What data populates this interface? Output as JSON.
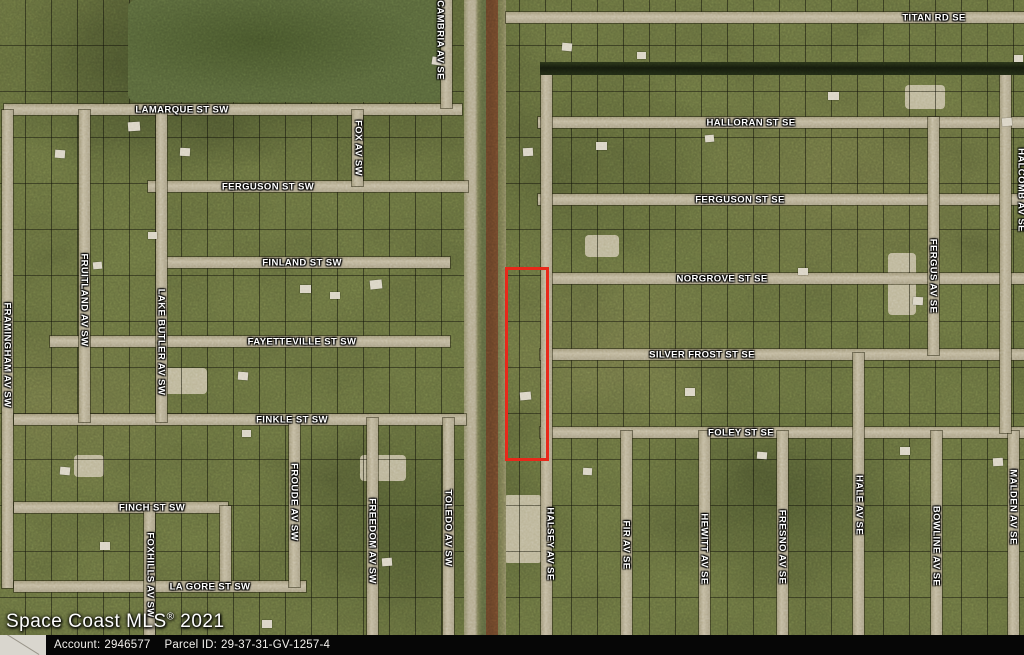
{
  "watermark": {
    "main": "Space Coast MLS",
    "reg": "®",
    "year": "2021"
  },
  "footer": {
    "account_label": "Account:",
    "account_value": "2946577",
    "parcel_label": "Parcel ID:",
    "parcel_value": "29-37-31-GV-1257-4"
  },
  "map": {
    "colors": {
      "highlight_parcel": "#e8281a",
      "road": "#b6ad93",
      "canal": "#1a210f",
      "boundary_line": "#6f2513",
      "footer_bar": "#060606"
    },
    "highlight_parcel": {
      "x": 505,
      "y": 267,
      "w": 38,
      "h": 188,
      "stroke": 3
    },
    "streets": [
      {
        "id": "lamarque-st-sw",
        "o": "h",
        "x": 4,
        "y": 104,
        "len": 458
      },
      {
        "id": "ferguson-st-sw",
        "o": "h",
        "x": 148,
        "y": 181,
        "len": 320
      },
      {
        "id": "finland-st-sw",
        "o": "h",
        "x": 160,
        "y": 257,
        "len": 290
      },
      {
        "id": "fayetteville-st-sw",
        "o": "h",
        "x": 50,
        "y": 336,
        "len": 400
      },
      {
        "id": "finkle-st-sw",
        "o": "h",
        "x": 14,
        "y": 414,
        "len": 452
      },
      {
        "id": "finch-st-sw",
        "o": "h",
        "x": 14,
        "y": 502,
        "len": 214
      },
      {
        "id": "la-gore-st-sw",
        "o": "h",
        "x": 14,
        "y": 581,
        "len": 292
      },
      {
        "id": "titan-rd-se",
        "o": "h",
        "x": 506,
        "y": 12,
        "len": 518
      },
      {
        "id": "halloran-st-se",
        "o": "h",
        "x": 538,
        "y": 117,
        "len": 486
      },
      {
        "id": "ferguson-st-se",
        "o": "h",
        "x": 538,
        "y": 194,
        "len": 486
      },
      {
        "id": "norgrove-st-se",
        "o": "h",
        "x": 548,
        "y": 273,
        "len": 476
      },
      {
        "id": "silver-frost-st-se",
        "o": "h",
        "x": 540,
        "y": 349,
        "len": 484
      },
      {
        "id": "foley-st-se",
        "o": "h",
        "x": 540,
        "y": 427,
        "len": 484
      },
      {
        "id": "cambria-av-se",
        "o": "v",
        "x": 441,
        "y": 0,
        "len": 108
      },
      {
        "id": "fox-av-sw",
        "o": "v",
        "x": 352,
        "y": 110,
        "len": 76
      },
      {
        "id": "framingham-av-sw",
        "o": "v",
        "x": 2,
        "y": 110,
        "len": 478
      },
      {
        "id": "fruitland-av-sw",
        "o": "v",
        "x": 79,
        "y": 110,
        "len": 312
      },
      {
        "id": "lake-butler-av-sw",
        "o": "v",
        "x": 156,
        "y": 110,
        "len": 312
      },
      {
        "id": "foxhills-av-sw",
        "o": "v",
        "x": 144,
        "y": 506,
        "len": 149
      },
      {
        "id": "finch-loop-connector",
        "o": "v",
        "x": 220,
        "y": 506,
        "len": 79
      },
      {
        "id": "froude-av-sw",
        "o": "v",
        "x": 289,
        "y": 418,
        "len": 169
      },
      {
        "id": "freedom-av-sw",
        "o": "v",
        "x": 367,
        "y": 418,
        "len": 237
      },
      {
        "id": "toledo-av-sw",
        "o": "v",
        "x": 443,
        "y": 418,
        "len": 237
      },
      {
        "id": "halsey-av-se",
        "o": "v",
        "x": 541,
        "y": 70,
        "len": 585
      },
      {
        "id": "fir-av-se",
        "o": "v",
        "x": 621,
        "y": 431,
        "len": 224
      },
      {
        "id": "hewitt-av-se",
        "o": "v",
        "x": 699,
        "y": 431,
        "len": 224
      },
      {
        "id": "fresno-av-se",
        "o": "v",
        "x": 777,
        "y": 431,
        "len": 224
      },
      {
        "id": "hale-av-se",
        "o": "v",
        "x": 853,
        "y": 353,
        "len": 302
      },
      {
        "id": "bowline-av-se",
        "o": "v",
        "x": 931,
        "y": 431,
        "len": 224
      },
      {
        "id": "malden-av-se",
        "o": "v",
        "x": 1008,
        "y": 431,
        "len": 224
      },
      {
        "id": "fergus-av-se",
        "o": "v",
        "x": 928,
        "y": 117,
        "len": 238
      },
      {
        "id": "halcomb-av-se",
        "o": "v",
        "x": 1000,
        "y": 70,
        "len": 363
      }
    ],
    "street_labels": [
      {
        "t": "LAMARQUE ST SW",
        "x": 182,
        "y": 110
      },
      {
        "t": "FERGUSON ST SW",
        "x": 268,
        "y": 187
      },
      {
        "t": "FINLAND ST SW",
        "x": 302,
        "y": 263
      },
      {
        "t": "FAYETTEVILLE ST SW",
        "x": 302,
        "y": 342
      },
      {
        "t": "FINKLE ST SW",
        "x": 292,
        "y": 420
      },
      {
        "t": "FINCH ST SW",
        "x": 152,
        "y": 508
      },
      {
        "t": "LA GORE ST SW",
        "x": 210,
        "y": 587
      },
      {
        "t": "TITAN RD SE",
        "x": 934,
        "y": 18
      },
      {
        "t": "HALLORAN ST SE",
        "x": 751,
        "y": 123
      },
      {
        "t": "FERGUSON ST SE",
        "x": 740,
        "y": 200
      },
      {
        "t": "NORGROVE ST SE",
        "x": 722,
        "y": 279
      },
      {
        "t": "SILVER FROST ST SE",
        "x": 702,
        "y": 355
      },
      {
        "t": "FOLEY ST SE",
        "x": 741,
        "y": 433
      },
      {
        "t": "CAMBRIA AV SE",
        "x": 440,
        "y": 40,
        "v": 1
      },
      {
        "t": "FOX AV SW",
        "x": 358,
        "y": 148,
        "v": 1
      },
      {
        "t": "FRAMINGHAM AV SW",
        "x": 7,
        "y": 355,
        "v": 1
      },
      {
        "t": "FRUITLAND AV SW",
        "x": 84,
        "y": 300,
        "v": 1
      },
      {
        "t": "LAKE BUTLER AV SW",
        "x": 161,
        "y": 342,
        "v": 1
      },
      {
        "t": "FOXHILLS AV SW",
        "x": 150,
        "y": 575,
        "v": 1
      },
      {
        "t": "FROUDE AV SW",
        "x": 294,
        "y": 502,
        "v": 1
      },
      {
        "t": "FREEDOM AV SW",
        "x": 372,
        "y": 541,
        "v": 1
      },
      {
        "t": "TOLEDO AV SW",
        "x": 448,
        "y": 528,
        "v": 1
      },
      {
        "t": "HALSEY AV SE",
        "x": 550,
        "y": 544,
        "v": 1
      },
      {
        "t": "FIR AV SE",
        "x": 626,
        "y": 545,
        "v": 1
      },
      {
        "t": "HEWITT AV SE",
        "x": 704,
        "y": 549,
        "v": 1
      },
      {
        "t": "FRESNO AV SE",
        "x": 782,
        "y": 547,
        "v": 1
      },
      {
        "t": "HALE AV SE",
        "x": 859,
        "y": 505,
        "v": 1
      },
      {
        "t": "BOWLINE AV SE",
        "x": 936,
        "y": 546,
        "v": 1
      },
      {
        "t": "MALDEN AV SE",
        "x": 1013,
        "y": 507,
        "v": 1
      },
      {
        "t": "FERGUS AV SE",
        "x": 933,
        "y": 276,
        "v": 1
      },
      {
        "t": "HALCOMB AV SE",
        "x": 1021,
        "y": 190,
        "v": 1
      }
    ],
    "forests": [
      {
        "x": 128,
        "y": 0,
        "w": 314,
        "h": 102
      }
    ],
    "clearings": [
      {
        "x": 163,
        "y": 368,
        "w": 44,
        "h": 26
      },
      {
        "x": 504,
        "y": 495,
        "w": 38,
        "h": 68
      },
      {
        "x": 888,
        "y": 253,
        "w": 28,
        "h": 62
      },
      {
        "x": 74,
        "y": 455,
        "w": 30,
        "h": 22
      },
      {
        "x": 360,
        "y": 455,
        "w": 46,
        "h": 26
      },
      {
        "x": 585,
        "y": 235,
        "w": 34,
        "h": 22
      },
      {
        "x": 905,
        "y": 85,
        "w": 40,
        "h": 24
      }
    ],
    "houses": [
      {
        "x": 128,
        "y": 122,
        "w": 12,
        "h": 9,
        "r": -4
      },
      {
        "x": 180,
        "y": 148,
        "w": 10,
        "h": 8,
        "r": 3
      },
      {
        "x": 300,
        "y": 285,
        "w": 11,
        "h": 8,
        "r": 0
      },
      {
        "x": 370,
        "y": 280,
        "w": 12,
        "h": 9,
        "r": -6
      },
      {
        "x": 432,
        "y": 57,
        "w": 10,
        "h": 8,
        "r": 8
      },
      {
        "x": 148,
        "y": 232,
        "w": 9,
        "h": 7,
        "r": 0
      },
      {
        "x": 93,
        "y": 262,
        "w": 9,
        "h": 7,
        "r": -5
      },
      {
        "x": 238,
        "y": 372,
        "w": 10,
        "h": 8,
        "r": 4
      },
      {
        "x": 330,
        "y": 292,
        "w": 10,
        "h": 7,
        "r": 0
      },
      {
        "x": 523,
        "y": 148,
        "w": 10,
        "h": 8,
        "r": -3
      },
      {
        "x": 596,
        "y": 142,
        "w": 11,
        "h": 8,
        "r": 0
      },
      {
        "x": 562,
        "y": 43,
        "w": 10,
        "h": 8,
        "r": 5
      },
      {
        "x": 828,
        "y": 92,
        "w": 11,
        "h": 8,
        "r": 0
      },
      {
        "x": 1002,
        "y": 118,
        "w": 10,
        "h": 8,
        "r": -4
      },
      {
        "x": 913,
        "y": 297,
        "w": 10,
        "h": 8,
        "r": 3
      },
      {
        "x": 798,
        "y": 268,
        "w": 10,
        "h": 7,
        "r": 0
      },
      {
        "x": 520,
        "y": 392,
        "w": 11,
        "h": 8,
        "r": -5
      },
      {
        "x": 685,
        "y": 388,
        "w": 10,
        "h": 8,
        "r": 0
      },
      {
        "x": 757,
        "y": 452,
        "w": 10,
        "h": 7,
        "r": 4
      },
      {
        "x": 900,
        "y": 447,
        "w": 10,
        "h": 8,
        "r": 0
      },
      {
        "x": 993,
        "y": 458,
        "w": 10,
        "h": 8,
        "r": -3
      },
      {
        "x": 242,
        "y": 430,
        "w": 9,
        "h": 7,
        "r": 0
      },
      {
        "x": 60,
        "y": 467,
        "w": 10,
        "h": 8,
        "r": 5
      },
      {
        "x": 100,
        "y": 542,
        "w": 10,
        "h": 8,
        "r": 0
      },
      {
        "x": 382,
        "y": 558,
        "w": 10,
        "h": 8,
        "r": -4
      },
      {
        "x": 262,
        "y": 620,
        "w": 10,
        "h": 8,
        "r": 0
      },
      {
        "x": 583,
        "y": 468,
        "w": 9,
        "h": 7,
        "r": 3
      },
      {
        "x": 637,
        "y": 52,
        "w": 9,
        "h": 7,
        "r": 0
      },
      {
        "x": 705,
        "y": 135,
        "w": 9,
        "h": 7,
        "r": -5
      },
      {
        "x": 1014,
        "y": 55,
        "w": 9,
        "h": 7,
        "r": 0
      },
      {
        "x": 430,
        "y": 640,
        "w": 10,
        "h": 8,
        "r": 0
      },
      {
        "x": 55,
        "y": 150,
        "w": 10,
        "h": 8,
        "r": 4
      }
    ]
  }
}
